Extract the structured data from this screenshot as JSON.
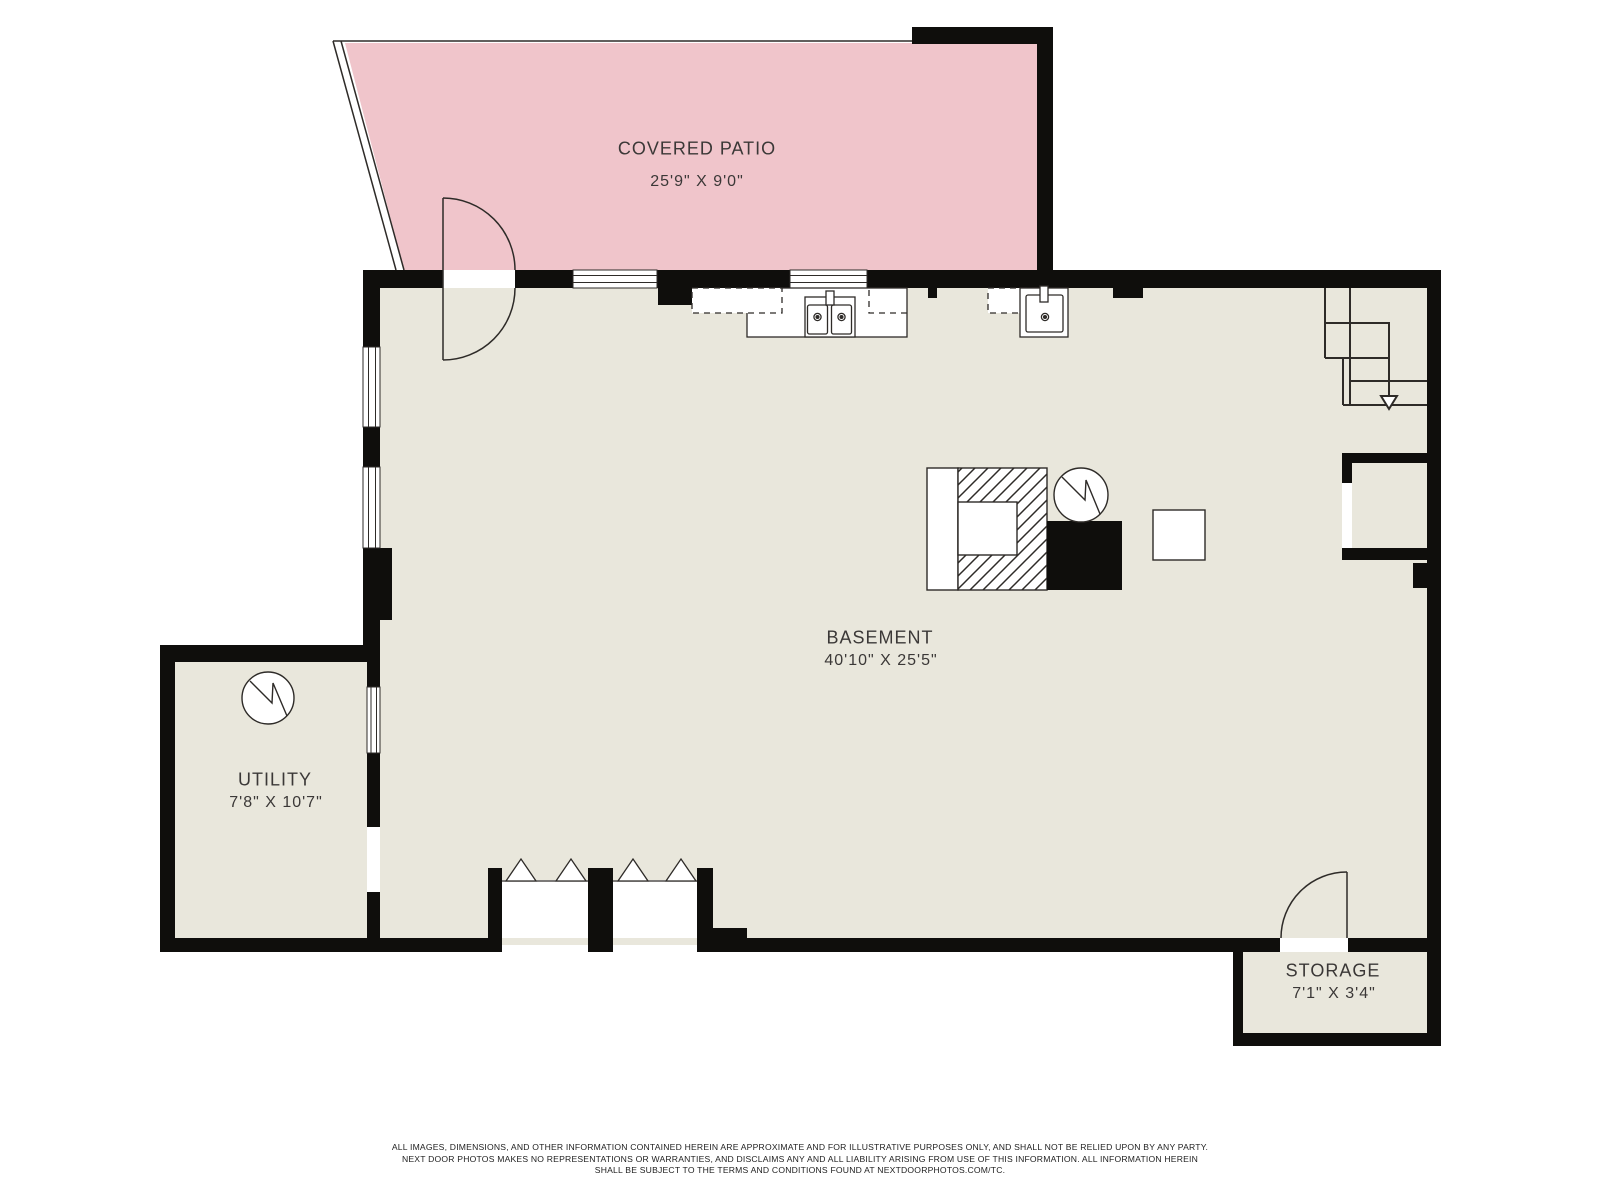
{
  "rooms": [
    {
      "name": "COVERED PATIO",
      "dimensions": "25'9\" X 9'0\""
    },
    {
      "name": "BASEMENT",
      "dimensions": "40'10\" X 25'5\""
    },
    {
      "name": "UTILITY",
      "dimensions": "7'8\" X 10'7\""
    },
    {
      "name": "STORAGE",
      "dimensions": "7'1\" X 3'4\""
    }
  ],
  "colors": {
    "patio_fill": "#f0c5cb",
    "floor_fill": "#e9e7dc",
    "wall": "#0f0e0c",
    "line": "#2e2b28",
    "text": "#3b3837"
  },
  "icons": {
    "water_heater": "circle-zigzag",
    "furnace": "hatched-square",
    "equipment": "solid-black-square",
    "sink": "basin-with-faucet",
    "stair_direction": "down-arrow",
    "window": "double-line-strip",
    "door": "quarter-arc-swing"
  },
  "footer": {
    "line1": "ALL IMAGES, DIMENSIONS, AND OTHER INFORMATION CONTAINED HEREIN ARE APPROXIMATE AND FOR ILLUSTRATIVE PURPOSES ONLY, AND SHALL NOT BE RELIED UPON BY ANY PARTY.",
    "line2": "NEXT DOOR PHOTOS MAKES NO REPRESENTATIONS OR WARRANTIES, AND DISCLAIMS ANY AND ALL LIABILITY ARISING FROM USE OF THIS INFORMATION. ALL INFORMATION HEREIN",
    "line3": "SHALL BE SUBJECT TO THE TERMS AND CONDITIONS FOUND AT NEXTDOORPHOTOS.COM/TC."
  }
}
